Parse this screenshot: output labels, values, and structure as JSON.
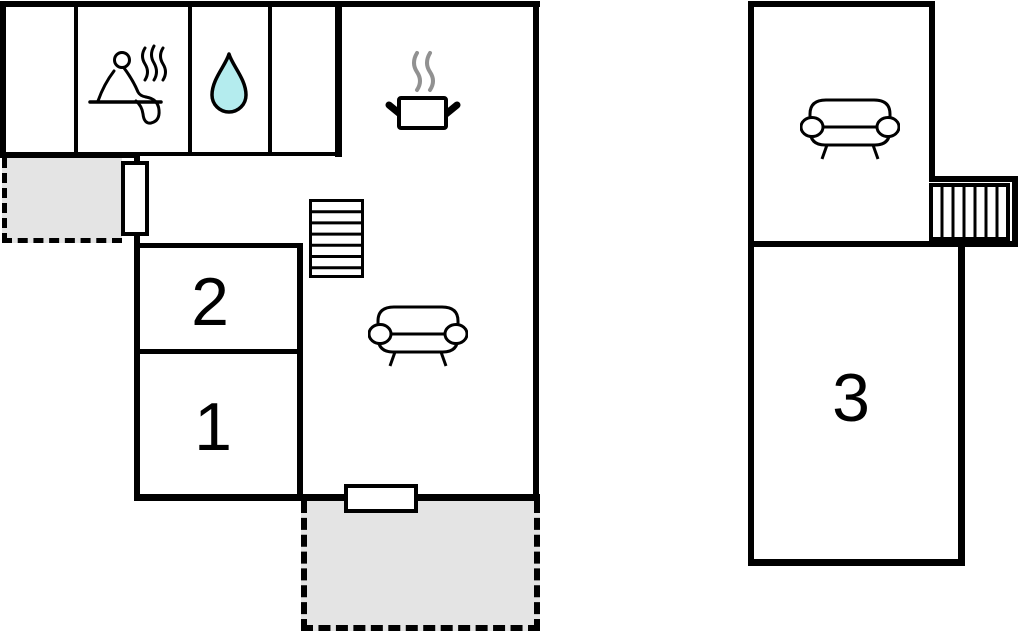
{
  "page": {
    "title": "Holiday home floor plan",
    "background": "#ffffff"
  },
  "palette": {
    "wall": "#000000",
    "terrace_fill": "#e4e4e4",
    "water_drop_fill": "#b4ecee",
    "pot_steam_gray": "#919191",
    "icon_stroke": "#000000"
  },
  "ground_floor": {
    "name": "main building",
    "rooms": {
      "room1": {
        "label": "1"
      },
      "room2": {
        "label": "2"
      },
      "sauna": {
        "icon": "sauna-icon"
      },
      "bathroom": {
        "icon": "water-drop-icon"
      },
      "kitchen_living": {
        "icons": [
          "cooking-pot-icon",
          "stairs-icon",
          "sofa-icon"
        ]
      }
    },
    "doors": [
      "west-door",
      "south-door"
    ],
    "terraces": [
      "top-left-terrace",
      "bottom-terrace"
    ]
  },
  "upper_floor": {
    "name": "annex / upper floor",
    "rooms": {
      "room3": {
        "label": "3"
      },
      "lounge": {
        "icons": [
          "sofa-icon",
          "stairs-icon"
        ]
      }
    }
  }
}
